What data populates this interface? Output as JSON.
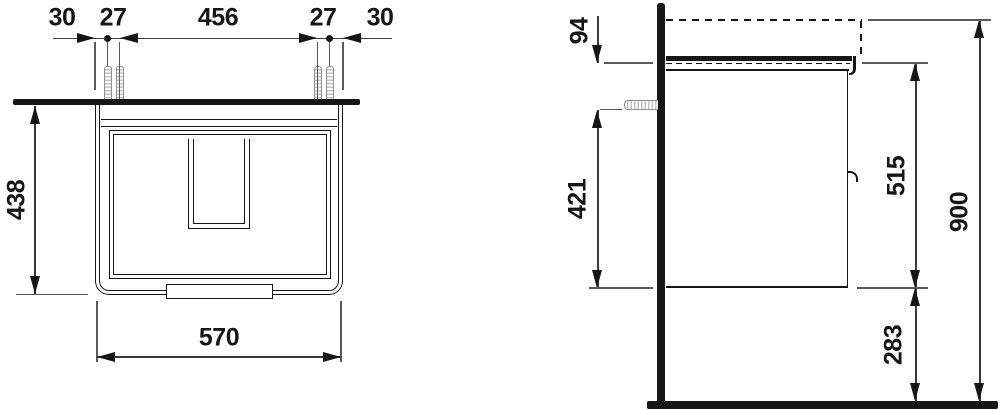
{
  "front_view": {
    "top_dims": [
      "30",
      "27",
      "456",
      "27",
      "30"
    ],
    "height_dim": "438",
    "width_dim": "570"
  },
  "side_view": {
    "basin_top_dim": "94",
    "screw_height_dim": "421",
    "cabinet_height_dim": "515",
    "total_height_dim": "900",
    "bottom_clearance_dim": "283"
  },
  "colors": {
    "line": "#161616",
    "dim_line": "#3a3a3a",
    "screw": "#8f8f8f",
    "background": "#ffffff"
  }
}
